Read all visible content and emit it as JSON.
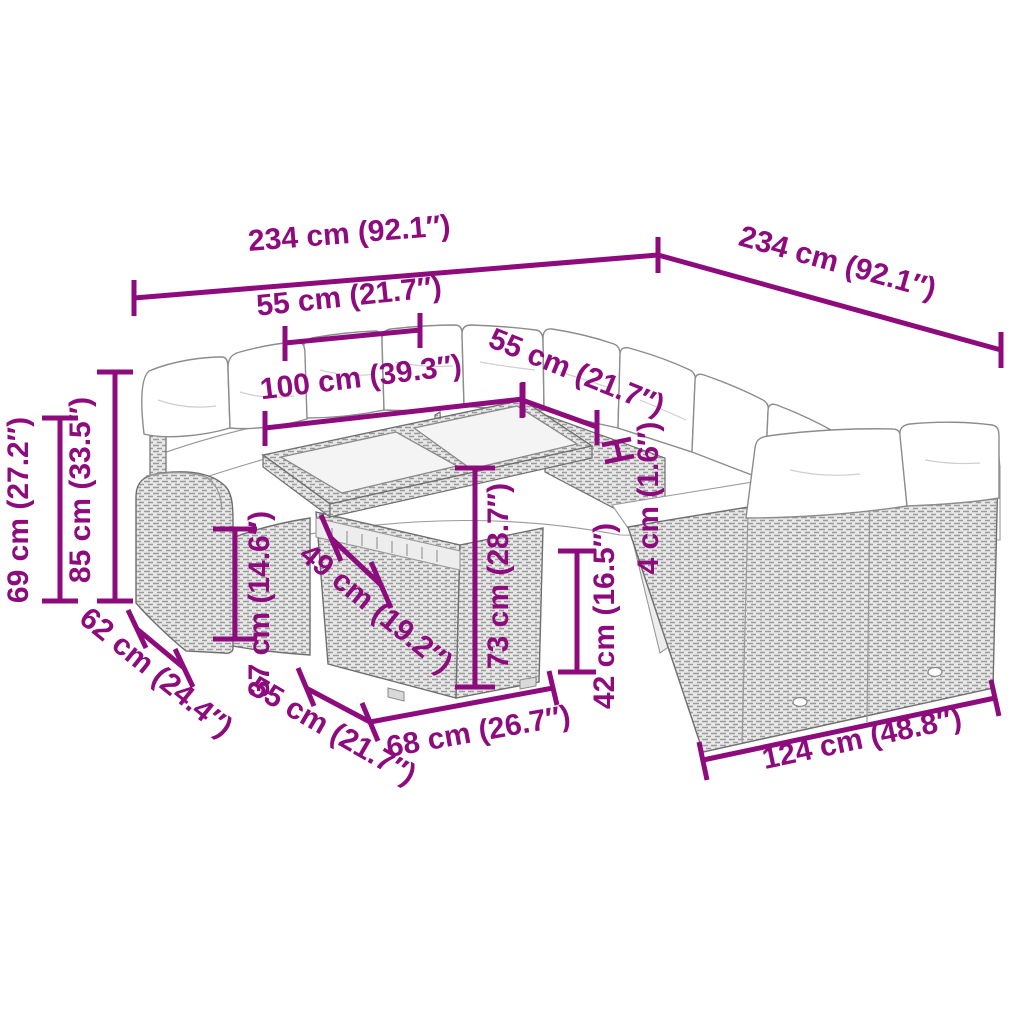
{
  "colors": {
    "dimension_accent": "#8E0B7E",
    "furniture_line": "#6F6F6F",
    "cushion_fill": "#FFFFFF",
    "glass_fill": "#F4F4F4"
  },
  "dimensions": {
    "back_width_left": "234 cm (92.1″)",
    "back_width_right": "234 cm (92.1″)",
    "seat_width": "55 cm (21.7″)",
    "table_span": "100 cm (39.3″)",
    "corner_seat_width": "55 cm (21.7″)",
    "backrest_height": "85 cm (33.5″)",
    "armrest_height": "69 cm (27.2″)",
    "side_depth": "62 cm (24.4″)",
    "seat_height_front": "37 cm (14.6″)",
    "table_top_depth": "49 cm (19.2″)",
    "table_height": "73 cm (28.7″)",
    "top_overhang": "4 cm (1.6″)",
    "seat_height_right": "42 cm (16.5″)",
    "seat_depth": "55 cm (21.7″)",
    "table_front_width": "68 cm (26.7″)",
    "right_section_width": "124 cm (48.8″)"
  }
}
